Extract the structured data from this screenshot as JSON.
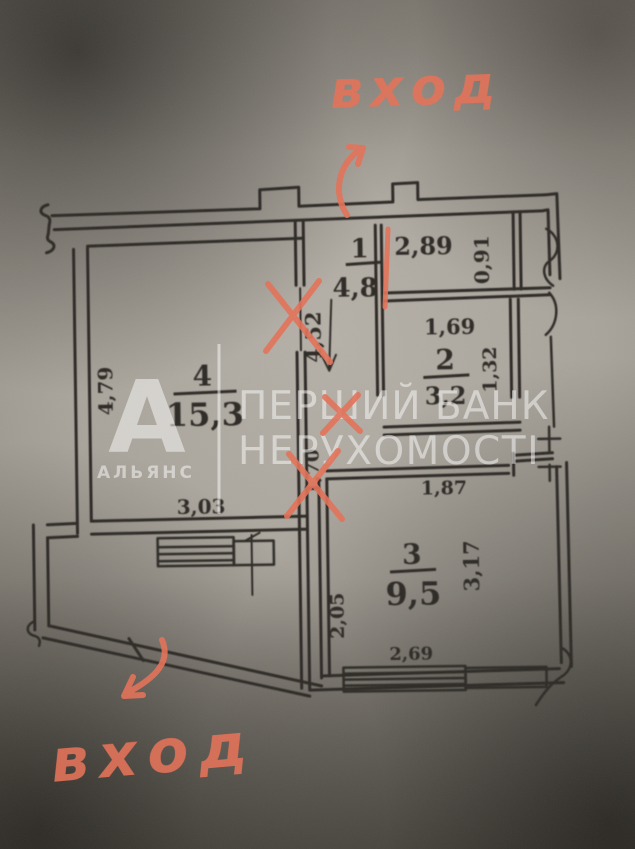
{
  "document": {
    "type": "apartment floor plan photograph"
  },
  "red_annotations": {
    "entrance_label_top": "вход",
    "entrance_label_bottom": "вход",
    "ink_color": "#e57258"
  },
  "watermark": {
    "logo_letter": "А",
    "logo_caption": "АЛЬЯНС",
    "title_line1": "ПЕРШИЙ БАНК",
    "title_line2": "НЕРУХОМОСТІ",
    "color": "#ffffff"
  },
  "rooms": {
    "room1": {
      "number": "1",
      "area": "4,8"
    },
    "room2": {
      "number": "2",
      "area": "3,2"
    },
    "room3": {
      "number": "3",
      "area": "9,5"
    },
    "room4": {
      "number": "4",
      "area": "15,3"
    }
  },
  "dimensions": {
    "d289": "2,89",
    "d091": "0,91",
    "d169": "1,69",
    "d132": "1,32",
    "d452": "4,52",
    "d170": "1,70",
    "d187": "1,87",
    "d479": "4,79",
    "d303": "3,03",
    "d317": "3,17",
    "d205": "2,05",
    "d269": "2,69"
  },
  "ink": {
    "plan_color": "#2e2b25"
  }
}
